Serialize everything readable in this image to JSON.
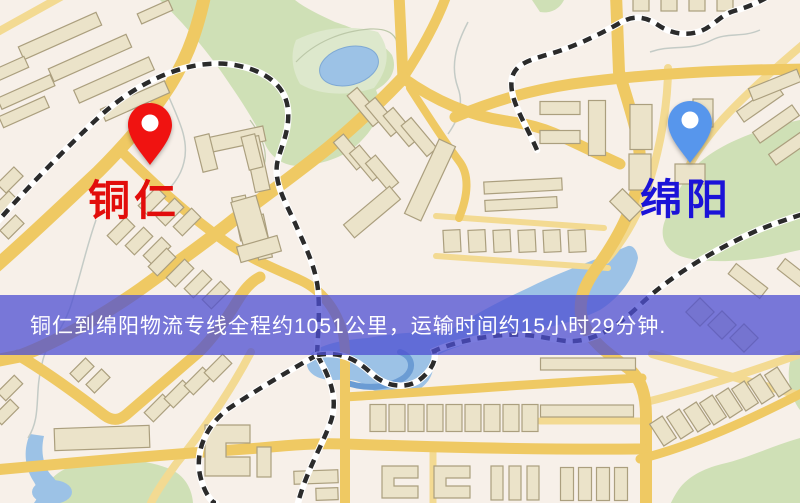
{
  "map": {
    "markers": [
      {
        "id": "tongren",
        "label": "铜仁",
        "pin_color": "#f01311",
        "label_color": "#e20d0b"
      },
      {
        "id": "mianyang",
        "label": "绵阳",
        "pin_color": "#5796ec",
        "label_color": "#1b13d8"
      }
    ],
    "banner": {
      "text": "铜仁到绵阳物流专线全程约1051公里，运输时间约15小时29分钟.",
      "background": "rgba(77,79,209,0.75)",
      "text_color": "#ffffff"
    },
    "palette": {
      "background": "#f7f0e9",
      "road_major": "#efc963",
      "road_minor": "#f3da92",
      "park": "#cfe0b6",
      "water": "#9cc2e6",
      "building": "#ebe3c9",
      "railway": "#2b2b2b"
    }
  }
}
